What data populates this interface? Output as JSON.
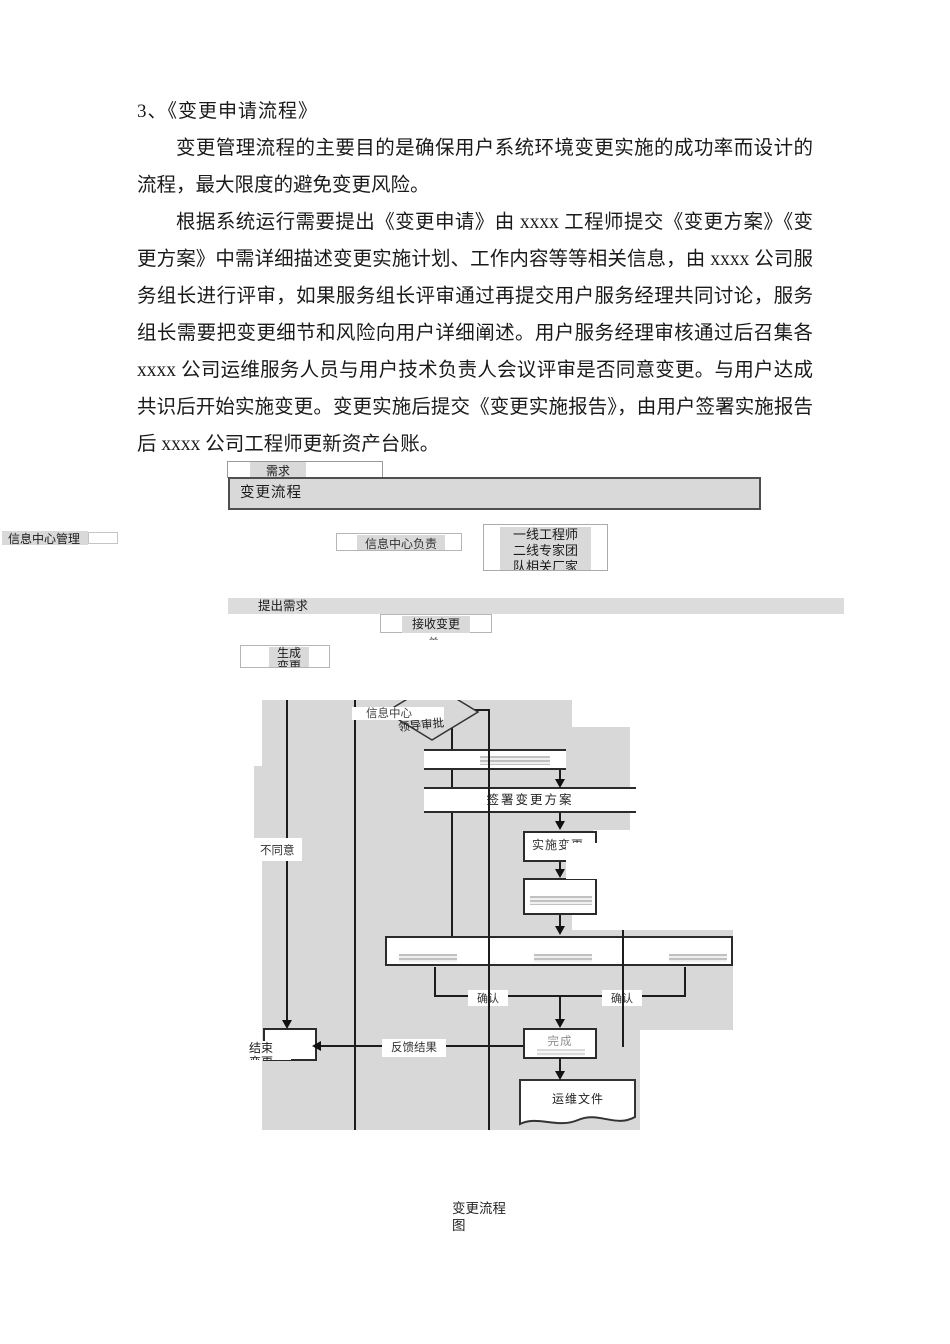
{
  "document": {
    "heading": "3、《变更申请流程》",
    "para1": "变更管理流程的主要目的是确保用户系统环境变更实施的成功率而设计的流程，最大限度的避免变更风险。",
    "para2": "根据系统运行需要提出《变更申请》由 xxxx 工程师提交《变更方案》《变更方案》中需详细描述变更实施计划、工作内容等等相关信息，由 xxxx 公司服务组长进行评审，如果服务组长评审通过再提交用户服务经理共同讨论，服务组长需要把变更细节和风险向用户详细阐述。用户服务经理审核通过后召集各 xxxx 公司运维服务人员与用户技术负责人会议评审是否同意变更。与用户达成共识后开始实施变更。变更实施后提交《变更实施报告》，由用户签署实施报告后 xxxx 公司工程师更新资产台账。",
    "caption": "变更流程\n图"
  },
  "flowchart": {
    "header": "变更流程",
    "clipped_need": "需求",
    "lane_left": "信息中心管理",
    "lane_mid": "信息中心负责",
    "engineers": "一线工程师\n二线专家团\n队相关厂家",
    "propose": "提出需求",
    "receive": "接收变更",
    "receive_tail": "单",
    "generate": "生成\n变更",
    "overlay_info": "信息中心",
    "diamond": "领导审批",
    "disagree": "不同意",
    "sign_plan": "签署变更方案",
    "implement": "实施变更",
    "confirm_left": "确认",
    "confirm_right": "确认",
    "feedback": "反馈结果",
    "end_change": "结束\n变更",
    "complete": "完成",
    "ops_doc": "运维文件"
  },
  "colors": {
    "gray_fill": "#d8d8d8",
    "bar_fill": "#d9d9d9",
    "line": "#1c1c1c",
    "text": "#1a1a1a"
  }
}
